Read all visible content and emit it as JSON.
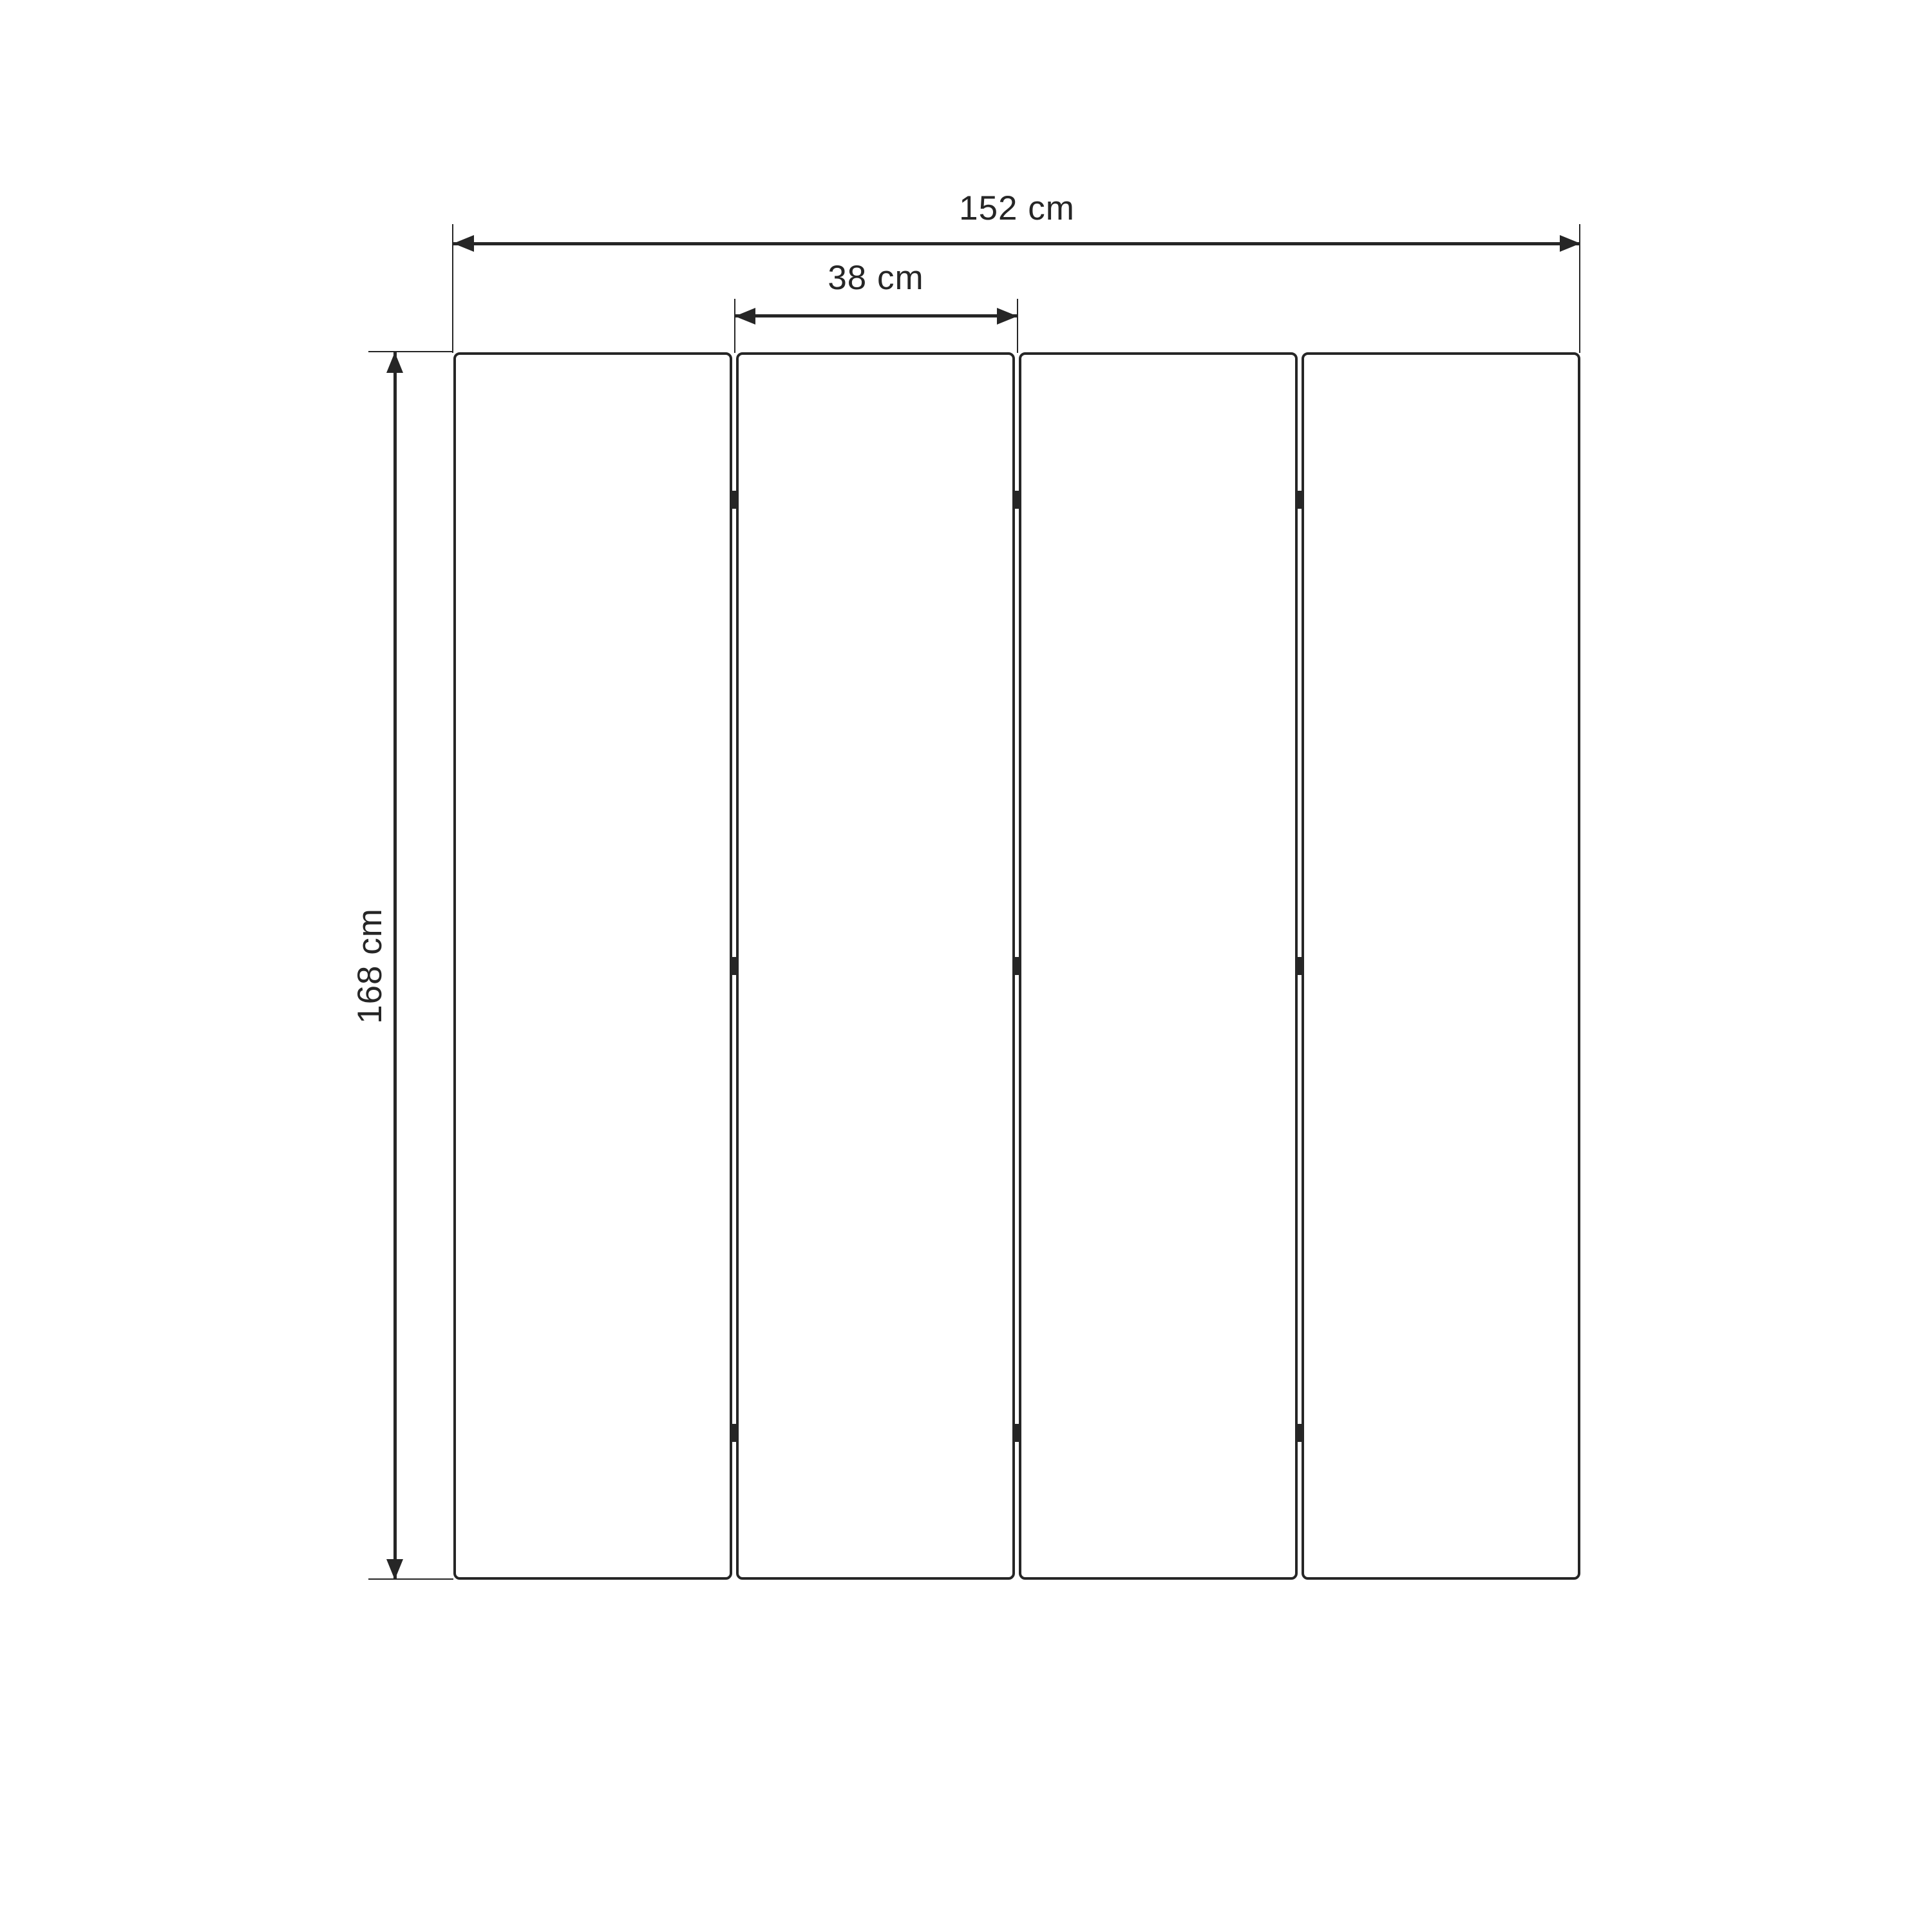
{
  "diagram": {
    "type": "panel-dimension-drawing",
    "background_color": "#ffffff",
    "line_color": "#262626",
    "panel_count": 4,
    "hinge_rows": 3,
    "dimensions": {
      "total_width_label": "152 cm",
      "panel_width_label": "38 cm",
      "height_label": "168 cm"
    }
  }
}
